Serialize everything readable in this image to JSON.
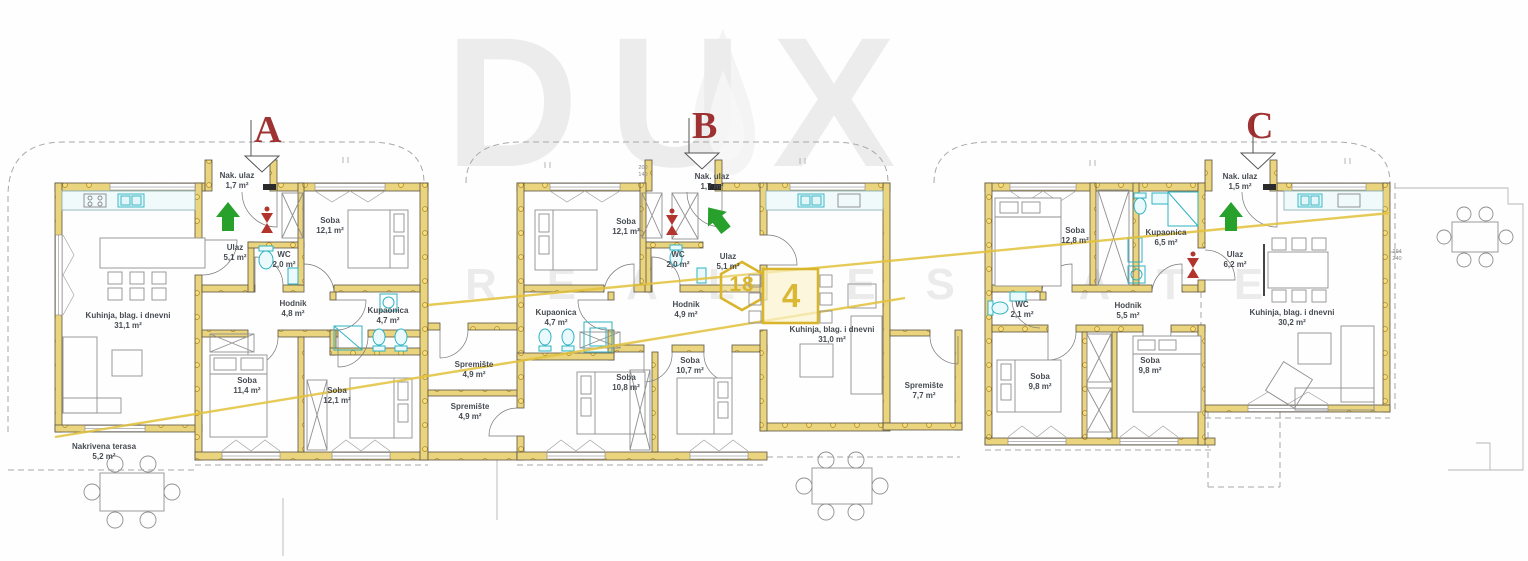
{
  "watermark": {
    "brand": "DUX",
    "tagline": "REAL ESTATE"
  },
  "sections": [
    {
      "label": "A"
    },
    {
      "label": "B"
    },
    {
      "label": "C"
    }
  ],
  "badges": {
    "hexagon": "18",
    "table": "4"
  },
  "colors": {
    "wall_fill": "#ead47e",
    "wall_stroke": "#5b5342",
    "fixture_teal": "#2fb3c2",
    "marker_red": "#951e1e",
    "arrow_green": "#27a02c",
    "annotation_yellow": "#d9b52e",
    "furniture_gray": "#8f8f8f",
    "label_text": "#474c52"
  },
  "rooms": [
    {
      "unit": "A",
      "name": "Nak. ulaz",
      "area": "1,7 m²",
      "x": 237,
      "y": 171
    },
    {
      "unit": "A",
      "name": "Ulaz",
      "area": "5,1 m²",
      "x": 235,
      "y": 243
    },
    {
      "unit": "A",
      "name": "WC",
      "area": "2,0 m²",
      "x": 284,
      "y": 250
    },
    {
      "unit": "A",
      "name": "Soba",
      "area": "12,1 m²",
      "x": 330,
      "y": 216
    },
    {
      "unit": "A",
      "name": "Hodnik",
      "area": "4,8 m²",
      "x": 293,
      "y": 299
    },
    {
      "unit": "A",
      "name": "Kupaonica",
      "area": "4,7 m²",
      "x": 388,
      "y": 306
    },
    {
      "unit": "A",
      "name": "Kuhinja, blag. i dnevni",
      "area": "31,1 m²",
      "x": 128,
      "y": 311
    },
    {
      "unit": "A",
      "name": "Soba",
      "area": "11,4 m²",
      "x": 247,
      "y": 376
    },
    {
      "unit": "A",
      "name": "Soba",
      "area": "12,1 m²",
      "x": 337,
      "y": 386
    },
    {
      "unit": "A",
      "name": "Nakrivena terasa",
      "area": "5,2 m²",
      "x": 104,
      "y": 442
    },
    {
      "unit": "A",
      "name": "Spremište",
      "area": "4,9 m²",
      "x": 474,
      "y": 360
    },
    {
      "unit": "B",
      "name": "Spremište",
      "area": "4,9 m²",
      "x": 470,
      "y": 402
    },
    {
      "unit": "B",
      "name": "Soba",
      "area": "12,1 m²",
      "x": 626,
      "y": 217
    },
    {
      "unit": "B",
      "name": "Nak. ulaz",
      "area": "1,7 m²",
      "x": 712,
      "y": 172
    },
    {
      "unit": "B",
      "name": "WC",
      "area": "2,0 m²",
      "x": 678,
      "y": 250
    },
    {
      "unit": "B",
      "name": "Ulaz",
      "area": "5,1 m²",
      "x": 728,
      "y": 252
    },
    {
      "unit": "B",
      "name": "Hodnik",
      "area": "4,9 m²",
      "x": 686,
      "y": 300
    },
    {
      "unit": "B",
      "name": "Kupaonica",
      "area": "4,7 m²",
      "x": 556,
      "y": 308
    },
    {
      "unit": "B",
      "name": "Kuhinja, blag. i dnevni",
      "area": "31,0 m²",
      "x": 832,
      "y": 325
    },
    {
      "unit": "B",
      "name": "Soba",
      "area": "10,8 m²",
      "x": 626,
      "y": 373
    },
    {
      "unit": "B",
      "name": "Soba",
      "area": "10,7 m²",
      "x": 690,
      "y": 356
    },
    {
      "unit": "B",
      "name": "Spremište",
      "area": "7,7 m²",
      "x": 924,
      "y": 381
    },
    {
      "unit": "C",
      "name": "Soba",
      "area": "12,8 m²",
      "x": 1075,
      "y": 226
    },
    {
      "unit": "C",
      "name": "Kupaonica",
      "area": "6,5 m²",
      "x": 1166,
      "y": 228
    },
    {
      "unit": "C",
      "name": "Nak. ulaz",
      "area": "1,5 m²",
      "x": 1240,
      "y": 172
    },
    {
      "unit": "C",
      "name": "Ulaz",
      "area": "6,2 m²",
      "x": 1235,
      "y": 250
    },
    {
      "unit": "C",
      "name": "WC",
      "area": "2,1 m²",
      "x": 1022,
      "y": 300
    },
    {
      "unit": "C",
      "name": "Hodnik",
      "area": "5,5 m²",
      "x": 1128,
      "y": 301
    },
    {
      "unit": "C",
      "name": "Kuhinja, blag. i dnevni",
      "area": "30,2 m²",
      "x": 1292,
      "y": 308
    },
    {
      "unit": "C",
      "name": "Soba",
      "area": "9,8 m²",
      "x": 1040,
      "y": 372
    },
    {
      "unit": "C",
      "name": "Soba",
      "area": "9,8 m²",
      "x": 1150,
      "y": 356
    }
  ],
  "dimensions": [
    {
      "t": "294",
      "x": 1397,
      "y": 249
    },
    {
      "t": "240",
      "x": 1397,
      "y": 256
    },
    {
      "t": "200",
      "x": 643,
      "y": 165
    },
    {
      "t": "140",
      "x": 643,
      "y": 172
    }
  ]
}
